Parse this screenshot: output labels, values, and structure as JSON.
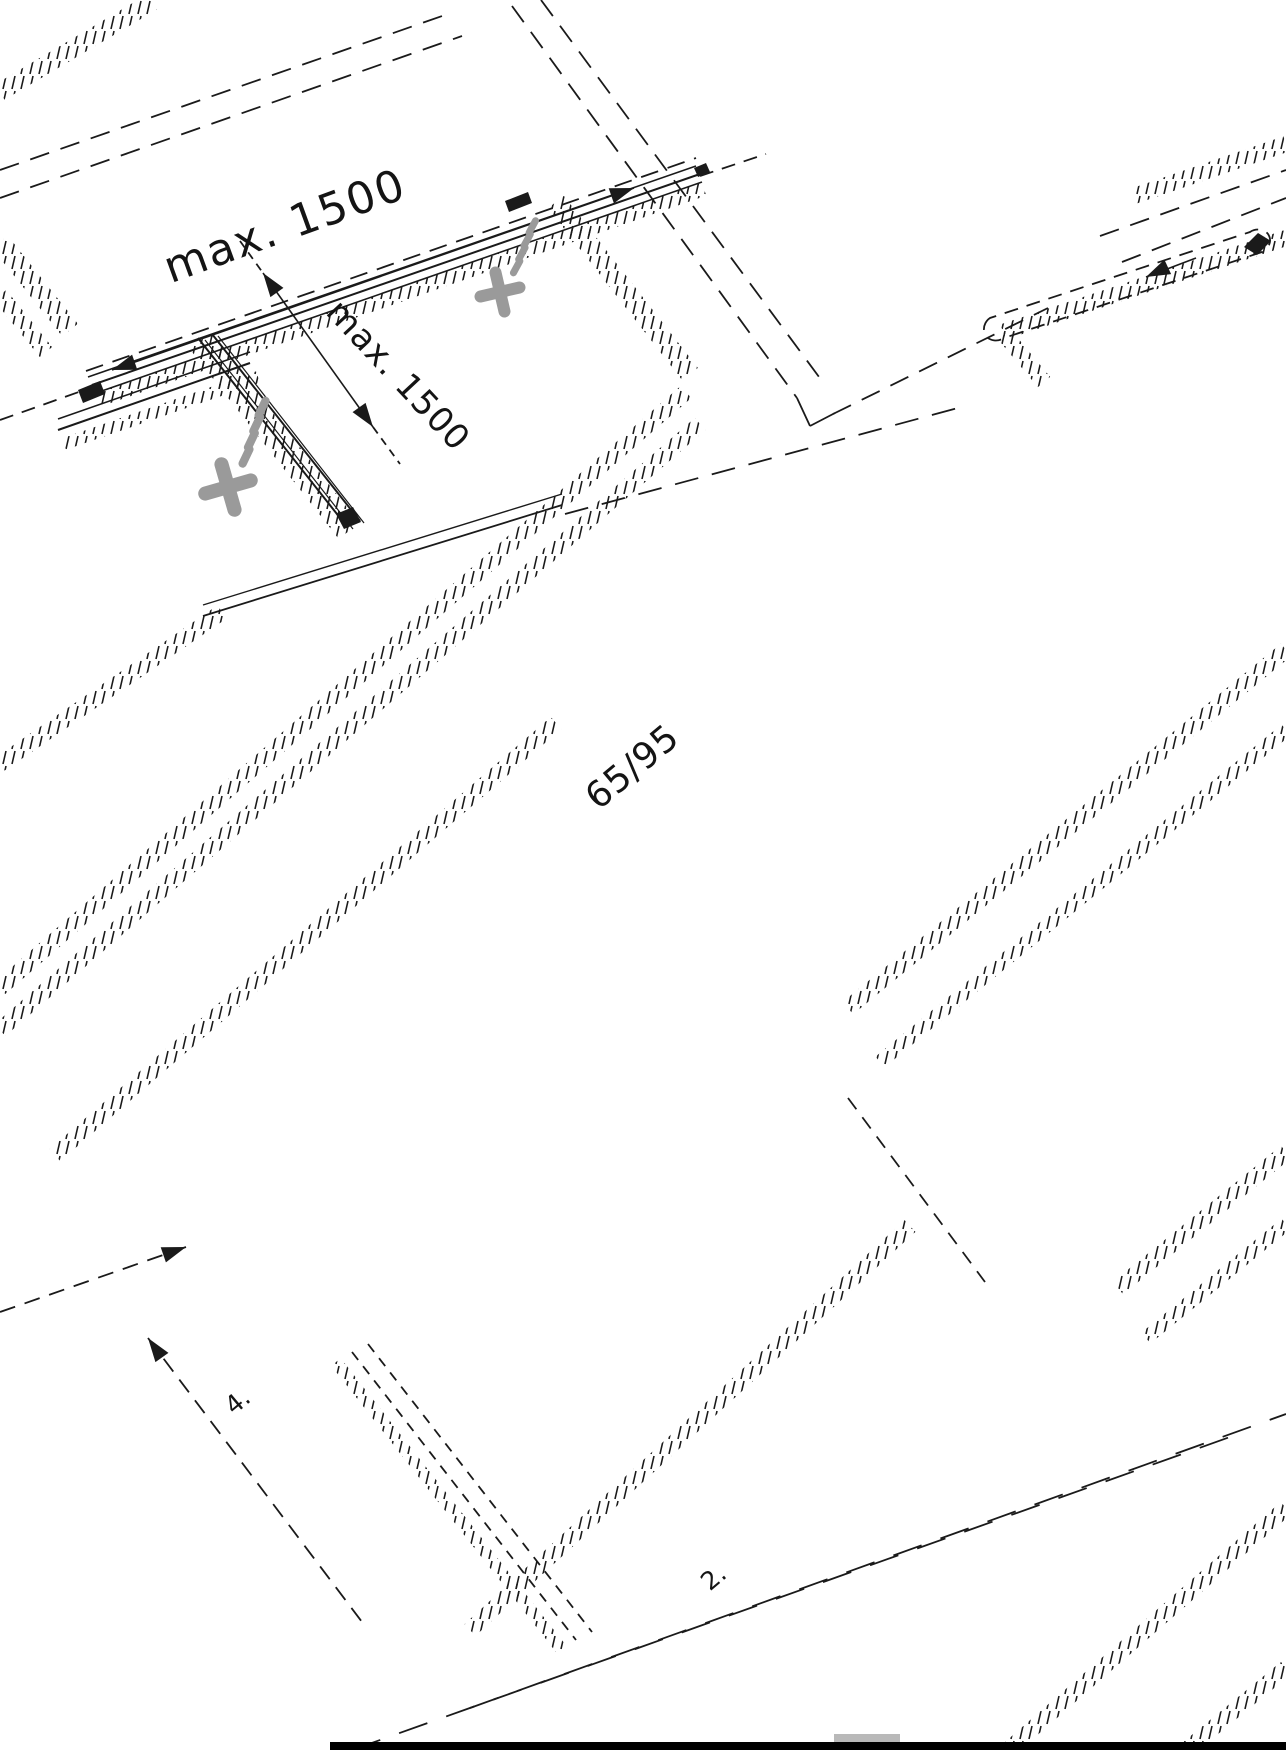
{
  "page": {
    "background": "#ffffff",
    "ink_color": "#1a1a1a",
    "screw_color": "#9a9a9a",
    "bottom_bar_color": "#000000",
    "bottom_strip_color": "#b9b9b9"
  },
  "drawing": {
    "kind": "isometric-assembly-line-drawing",
    "labels": {
      "dim_top": "max. 1500",
      "dim_side": "max. 1500",
      "dim_center": "65/95",
      "step_left": "4.",
      "step_bottom": "2."
    },
    "icons": [
      "phillips-screw-icon",
      "phillips-screw-icon",
      "arrowhead-icon"
    ]
  }
}
